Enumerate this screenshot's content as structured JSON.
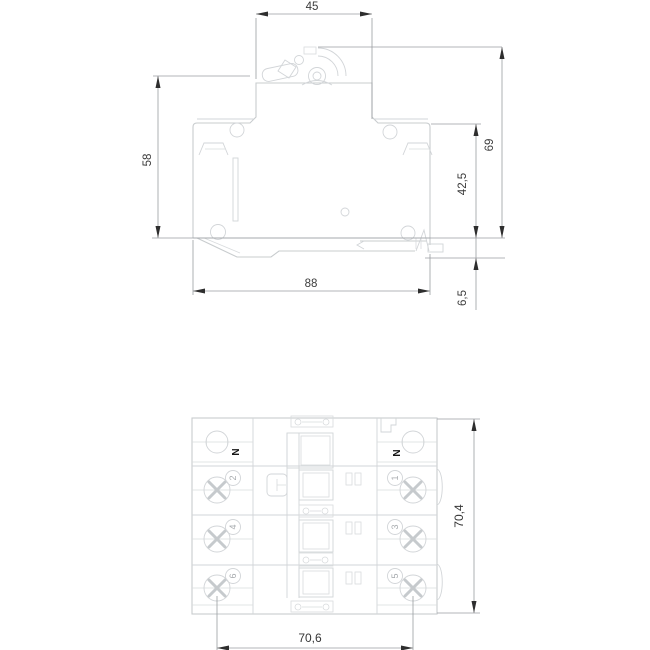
{
  "drawing": {
    "top_view": {
      "dim_top_width": "45",
      "dim_left_height": "58",
      "dim_total_height": "69",
      "dim_body_height": "42,5",
      "dim_din_depth": "6,5",
      "dim_bottom_width": "88"
    },
    "bottom_view": {
      "dim_total_height": "70,4",
      "dim_terminal_spacing": "70,6",
      "left_neutral_label": "N",
      "right_neutral_label": "N",
      "left_terminal_numbers": [
        "2",
        "4",
        "6"
      ],
      "right_terminal_numbers": [
        "1",
        "3",
        "5"
      ]
    }
  }
}
